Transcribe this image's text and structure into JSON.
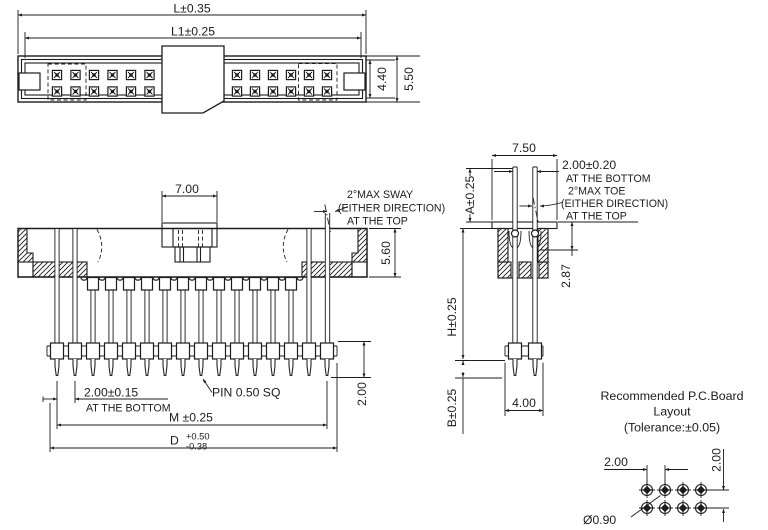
{
  "style": {
    "ink": "#1c1c1c",
    "background": "#ffffff"
  },
  "top_view": {
    "dim_overall": "L±0.35",
    "dim_inner": "L1±0.25",
    "dim_height_inner": "4.40",
    "dim_height_outer": "5.50"
  },
  "front_view": {
    "dim_key": "7.00",
    "sway_note_1": "2°MAX SWAY",
    "sway_note_2": "(EITHER DIRECTION)",
    "sway_note_3": "AT THE TOP",
    "dim_body_height": "5.60",
    "dim_pin_pitch": "2.00±0.15",
    "pin_pitch_note": "AT THE BOTTOM",
    "pin_size_note": "PIN 0.50 SQ",
    "dim_pin_span": "M ±0.25",
    "dim_overall": "D",
    "dim_overall_plus": "+0.50",
    "dim_overall_minus": "-0.38",
    "dim_pin_tail": "2.00"
  },
  "side_view": {
    "dim_width": "7.50",
    "dim_pin_above": "A±0.25",
    "dim_row_pitch": "2.00±0.20",
    "row_pitch_note": "AT THE BOTTOM",
    "toe_note_1": "2°MAX TOE",
    "toe_note_2": "(EITHER DIRECTION)",
    "toe_note_3": "AT THE TOP",
    "dim_contact_depth": "2.87",
    "dim_pin_height": "H±0.25",
    "dim_pin_below": "B±0.25",
    "dim_spacer_width": "4.00"
  },
  "pcb_layout": {
    "title_line1": "Recommended  P.C.Board",
    "title_line2": "Layout",
    "title_line3": "(Tolerance:±0.05)",
    "dim_hole_pitch_x": "2.00",
    "dim_hole_pitch_y": "2.00",
    "dim_hole_dia": "Ø0.90"
  }
}
